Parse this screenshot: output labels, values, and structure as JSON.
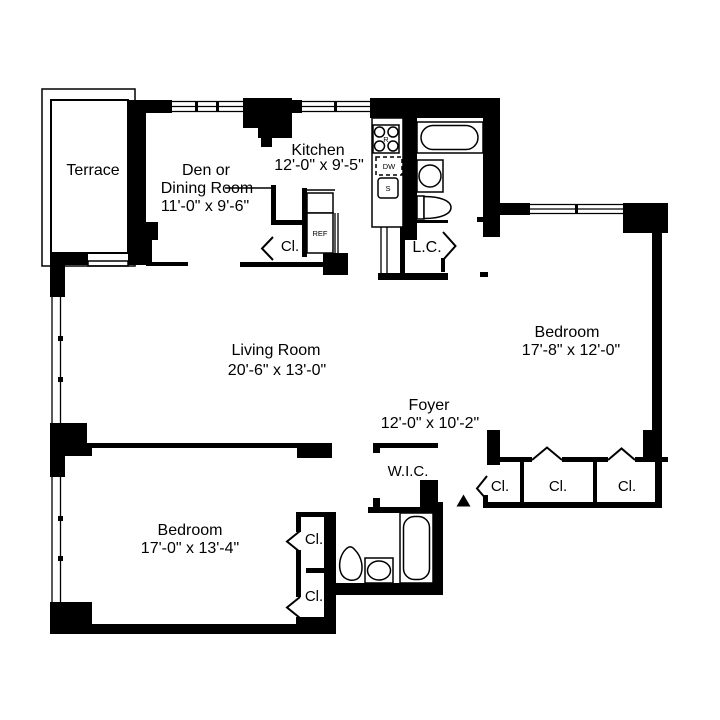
{
  "floorplan": {
    "rooms": {
      "terrace": {
        "label": "Terrace"
      },
      "den": {
        "line1": "Den or",
        "line2": "Dining Room",
        "dims": "11'-0\" x 9'-6\""
      },
      "kitchen": {
        "label": "Kitchen",
        "dims": "12'-0\" x 9'-5\""
      },
      "living_room": {
        "label": "Living Room",
        "dims": "20'-6\" x 13'-0\""
      },
      "foyer": {
        "label": "Foyer",
        "dims": "12'-0\" x 10'-2\""
      },
      "bedroom_right": {
        "label": "Bedroom",
        "dims": "17'-8\" x 12'-0\""
      },
      "bedroom_left": {
        "label": "Bedroom",
        "dims": "17'-0\" x 13'-4\""
      },
      "walk_in_closet": {
        "label": "W.I.C."
      },
      "linen_closet": {
        "label": "L.C."
      }
    },
    "closet_label": "Cl.",
    "fixtures": {
      "refrigerator": "REF",
      "range": "R",
      "dishwasher": "DW",
      "kitchen_sink": "S"
    },
    "colors": {
      "line": "#000000",
      "background": "#ffffff"
    }
  }
}
